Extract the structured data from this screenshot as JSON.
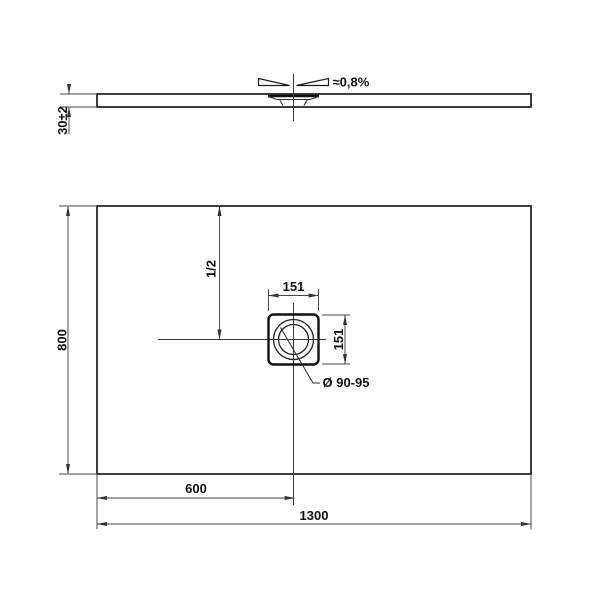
{
  "colors": {
    "line": "#1c1c1c",
    "background": "#ffffff"
  },
  "side_view": {
    "thickness_dim": "30±2",
    "slope_label": "≈0,8%"
  },
  "plan_view": {
    "length_dim": "1300",
    "width_dim": "800",
    "drain_offset_dim": "600",
    "center_dim": "1/2",
    "drain_square_width_dim": "151",
    "drain_square_height_dim": "151",
    "drain_diameter_label": "Ø 90-95"
  }
}
